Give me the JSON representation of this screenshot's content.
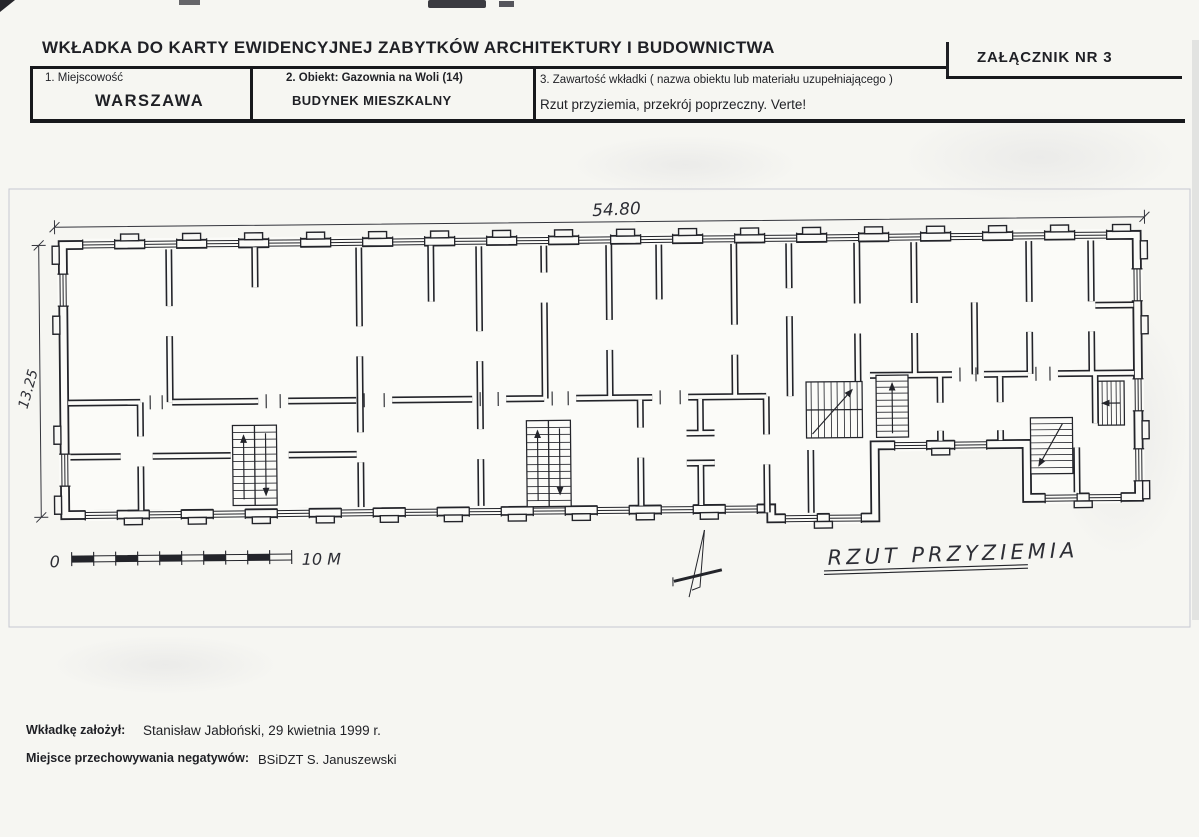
{
  "header": {
    "title": "WKŁADKA DO KARTY EWIDENCYJNEJ ZABYTKÓW ARCHITEKTURY I BUDOWNICTWA",
    "attachment": "ZAŁĄCZNIK NR 3"
  },
  "table": {
    "col1_label": "1. Miejscowość",
    "col1_value": "WARSZAWA",
    "col2_label": "2. Obiekt: Gazownia na Woli (14)",
    "col2_value": "BUDYNEK MIESZKALNY",
    "col3_label": "3. Zawartość wkładki ( nazwa obiektu lub materiału uzupełniającego )",
    "col3_value": "Rzut przyziemia, przekrój poprzeczny. Verte!"
  },
  "drawing": {
    "plan_title": "RZUT PRZYZIEMIA",
    "width_dim": "54.80",
    "height_dim": "13.25",
    "scale_zero": "0",
    "scale_end": "10 M"
  },
  "footer": {
    "created_label": "Wkładkę założył:",
    "created_value": "Stanisław Jabłoński, 29 kwietnia 1999 r.",
    "negatives_label": "Miejsce przechowywania negatywów:",
    "negatives_value": "BSiDZT S. Januszewski"
  },
  "colors": {
    "ink": "#23242a",
    "paper": "#f6f6f2"
  }
}
